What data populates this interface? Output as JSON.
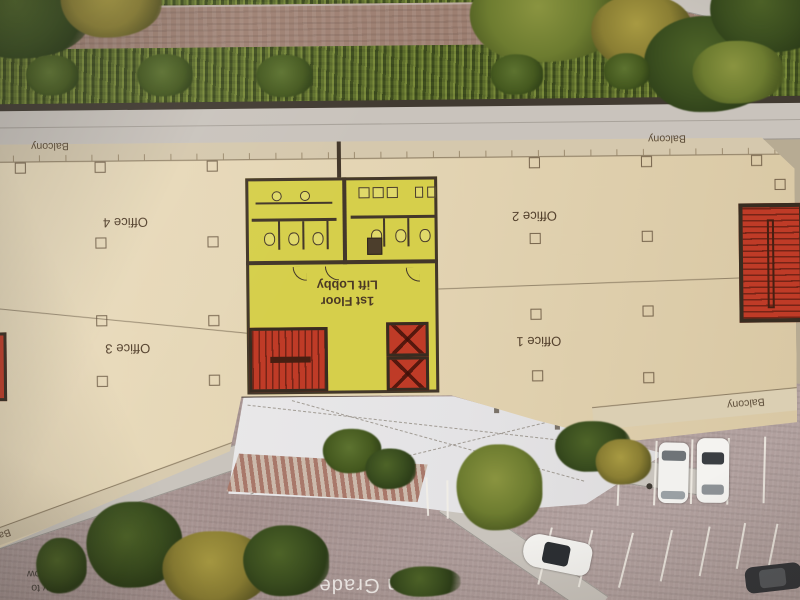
{
  "colors": {
    "slab_beige": "#e4d5b6",
    "core_yellow": "#d6cf4b",
    "stair_red": "#bf3b27",
    "wall_dark": "#43372a",
    "plaza_white": "#e9e8e9",
    "parking_mauve": "#b1a09e",
    "walkway_gray": "#c9c4bd",
    "hedge_green": "#5b6a2d",
    "brick_path": "#9d7f71"
  },
  "labels": {
    "balcony_top_left": "Balcony",
    "balcony_top_right": "Balcony",
    "balcony_bottom_right": "Balcony",
    "balcony_bottom_left": "Balcony",
    "office_4": "Office 4",
    "office_2": "Office 2",
    "office_3": "Office 3",
    "office_1": "Office 1",
    "lobby_line1": "1st Floor",
    "lobby_line2": "Lift Lobby",
    "on_grade": "on Grade",
    "entry_line1": "Entry to",
    "entry_line2": "P2 Below"
  }
}
